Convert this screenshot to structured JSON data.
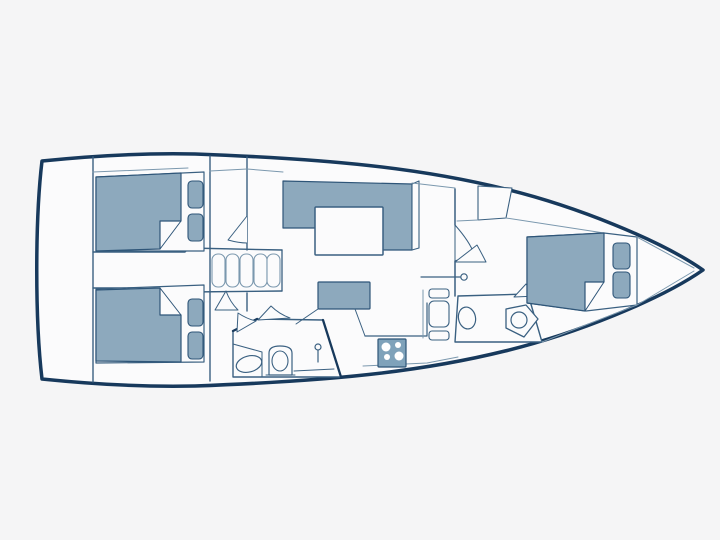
{
  "canvas": {
    "width": 720,
    "height": 540
  },
  "palette": {
    "background": "#f5f5f6",
    "hull_fill": "#fbfbfc",
    "hull_stroke": "#17395c",
    "line": "#3a6081",
    "line_light": "#7b98ae",
    "furniture_fill": "#8dا9bd",
    "furniture_fill_fix": "#8da9bd",
    "furniture_stroke": "#2e5578",
    "stove_fill": "#7fa2ba",
    "white": "#ffffff"
  },
  "floorplan": {
    "shapes": [
      {
        "name": "hull-outline",
        "kind": "path",
        "d": "M42,161 C100,155 150,153 195,154 C330,159 420,168 505,189 C575,206 660,240 703,270 C660,300 575,334 505,351 C420,372 330,381 195,386 C150,387 100,385 42,379 C35,320 35,220 42,161 Z",
        "fill": "hull_fill",
        "stroke": "hull_stroke",
        "sw": 3.5
      },
      {
        "name": "transom-line",
        "kind": "line",
        "x1": 93,
        "y1": 157,
        "x2": 93,
        "y2": 382,
        "stroke": "line",
        "sw": 1.4
      },
      {
        "name": "deck-line-aft-top",
        "kind": "line",
        "x1": 93,
        "y1": 172,
        "x2": 188,
        "y2": 168,
        "stroke": "line_light",
        "sw": 1
      },
      {
        "name": "corridor-top-wall",
        "kind": "path",
        "d": "M93,252 L185,252 L189,248 L282,250",
        "fill": "none",
        "stroke": "line",
        "sw": 1.4
      },
      {
        "name": "corridor-bottom-wall",
        "kind": "path",
        "d": "M93,288 L185,288 L189,292 L282,291",
        "fill": "none",
        "stroke": "line",
        "sw": 1.4
      },
      {
        "name": "aft-port-bed-base",
        "kind": "path",
        "d": "M96,177 L204,172 L204,251 L96,251 Z",
        "fill": "hull_fill",
        "stroke": "line",
        "sw": 1.2
      },
      {
        "name": "aft-port-bed",
        "kind": "path",
        "d": "M96,177 L181,173 L181,221 L160,221 L160,249 L96,251 Z",
        "fill": "furniture_fill_fix",
        "stroke": "furniture_stroke",
        "sw": 1.2
      },
      {
        "name": "aft-port-bed-fold-line",
        "kind": "line",
        "x1": 160,
        "y1": 249,
        "x2": 181,
        "y2": 221,
        "stroke": "furniture_stroke",
        "sw": 1
      },
      {
        "name": "aft-port-pillow-1",
        "kind": "rect",
        "x": 188,
        "y": 181,
        "w": 15,
        "h": 27,
        "rx": 4,
        "fill": "furniture_fill_fix",
        "stroke": "furniture_stroke",
        "sw": 1.1
      },
      {
        "name": "aft-port-pillow-2",
        "kind": "rect",
        "x": 188,
        "y": 214,
        "w": 15,
        "h": 27,
        "rx": 4,
        "fill": "furniture_fill_fix",
        "stroke": "furniture_stroke",
        "sw": 1.1
      },
      {
        "name": "aft-stbd-bed-base",
        "kind": "path",
        "d": "M96,289 L204,285 L204,362 L96,363 Z",
        "fill": "hull_fill",
        "stroke": "line",
        "sw": 1.2
      },
      {
        "name": "aft-stbd-bed",
        "kind": "path",
        "d": "M96,290 L160,288 L160,315 L181,315 L181,362 L96,361 Z",
        "fill": "furniture_fill_fix",
        "stroke": "furniture_stroke",
        "sw": 1.2
      },
      {
        "name": "aft-stbd-bed-fold-line",
        "kind": "line",
        "x1": 160,
        "y1": 288,
        "x2": 181,
        "y2": 315,
        "stroke": "furniture_stroke",
        "sw": 1
      },
      {
        "name": "aft-stbd-pillow-1",
        "kind": "rect",
        "x": 188,
        "y": 299,
        "w": 15,
        "h": 27,
        "rx": 4,
        "fill": "furniture_fill_fix",
        "stroke": "furniture_stroke",
        "sw": 1.1
      },
      {
        "name": "aft-stbd-pillow-2",
        "kind": "rect",
        "x": 188,
        "y": 332,
        "w": 15,
        "h": 27,
        "rx": 4,
        "fill": "furniture_fill_fix",
        "stroke": "furniture_stroke",
        "sw": 1.1
      },
      {
        "name": "wall-inner-aft",
        "kind": "line",
        "x1": 210,
        "y1": 156,
        "x2": 210,
        "y2": 381,
        "stroke": "line",
        "sw": 1.4
      },
      {
        "name": "wall-closet-top",
        "kind": "line",
        "x1": 247,
        "y1": 157,
        "x2": 247,
        "y2": 250,
        "stroke": "line",
        "sw": 1.4
      },
      {
        "name": "wall-closet-bottom",
        "kind": "line",
        "x1": 247,
        "y1": 293,
        "x2": 247,
        "y2": 311,
        "stroke": "line",
        "sw": 1.4
      },
      {
        "name": "deck-line-mid-top",
        "kind": "line",
        "x1": 210,
        "y1": 171,
        "x2": 247,
        "y2": 169,
        "stroke": "line_light",
        "sw": 1
      },
      {
        "name": "closet-door-swing",
        "kind": "path",
        "d": "M247,216 L228,240 Q239,243 247,243",
        "fill": "hull_fill",
        "stroke": "line",
        "sw": 1
      },
      {
        "name": "companionway-step-1",
        "kind": "rect",
        "x": 212,
        "y": 254,
        "w": 13,
        "h": 33,
        "rx": 6,
        "fill": "hull_fill",
        "stroke": "line_light",
        "sw": 1.1
      },
      {
        "name": "companionway-step-2",
        "kind": "rect",
        "x": 226,
        "y": 254,
        "w": 13,
        "h": 33,
        "rx": 6,
        "fill": "hull_fill",
        "stroke": "line_light",
        "sw": 1.1
      },
      {
        "name": "companionway-step-3",
        "kind": "rect",
        "x": 240,
        "y": 254,
        "w": 13,
        "h": 33,
        "rx": 6,
        "fill": "hull_fill",
        "stroke": "line_light",
        "sw": 1.1
      },
      {
        "name": "companionway-step-4",
        "kind": "rect",
        "x": 254,
        "y": 254,
        "w": 13,
        "h": 33,
        "rx": 6,
        "fill": "hull_fill",
        "stroke": "line_light",
        "sw": 1.1
      },
      {
        "name": "companionway-step-5",
        "kind": "rect",
        "x": 267,
        "y": 254,
        "w": 13,
        "h": 33,
        "rx": 6,
        "fill": "hull_fill",
        "stroke": "line_light",
        "sw": 1.1
      },
      {
        "name": "steps-right-wall",
        "kind": "line",
        "x1": 282,
        "y1": 250,
        "x2": 282,
        "y2": 291,
        "stroke": "line",
        "sw": 1.3
      },
      {
        "name": "aft-head-room",
        "kind": "path",
        "d": "M233,331 L257,319 L323,320 L341,377 L233,377 Z",
        "fill": "hull_fill",
        "stroke": "line",
        "sw": 1.4
      },
      {
        "name": "aft-head-thick-walls",
        "kind": "path",
        "d": "M257,319 L233,331 M323,320 L341,377",
        "fill": "none",
        "stroke": "hull_stroke",
        "sw": 2.3
      },
      {
        "name": "cabin-door-swing-stbd",
        "kind": "path",
        "d": "M215,310 L226,291 Q230,302 238,310 Z",
        "fill": "hull_fill",
        "stroke": "line",
        "sw": 1
      },
      {
        "name": "aft-head-door-swing-left",
        "kind": "path",
        "d": "M237,332 L238,313 Q247,319 256,321 Z",
        "fill": "hull_fill",
        "stroke": "line",
        "sw": 1
      },
      {
        "name": "aft-head-door-swing-right",
        "kind": "path",
        "d": "M258,320 L271,306 Q279,314 290,318 Z",
        "fill": "hull_fill",
        "stroke": "line",
        "sw": 1
      },
      {
        "name": "aft-head-counter-line",
        "kind": "path",
        "d": "M233,344 L262,352 L262,377",
        "fill": "none",
        "stroke": "line",
        "sw": 1
      },
      {
        "name": "aft-head-sink",
        "kind": "ellipse",
        "cx": 249,
        "cy": 364,
        "rx": 13,
        "ry": 8,
        "rot": -15,
        "fill": "hull_fill",
        "stroke": "line",
        "sw": 1.2
      },
      {
        "name": "aft-head-toilet-body",
        "kind": "path",
        "d": "M269,375 L269,353 Q269,346 280,346 Q292,346 292,353 L292,375 Z",
        "fill": "hull_fill",
        "stroke": "line",
        "sw": 1.2
      },
      {
        "name": "aft-head-toilet-bowl",
        "kind": "ellipse",
        "cx": 280,
        "cy": 361,
        "rx": 8,
        "ry": 10,
        "fill": "hull_fill",
        "stroke": "line",
        "sw": 1.1
      },
      {
        "name": "aft-head-toilet-base-line",
        "kind": "line",
        "x1": 266,
        "y1": 375,
        "x2": 295,
        "y2": 375,
        "stroke": "line",
        "sw": 1
      },
      {
        "name": "aft-head-shelf-line",
        "kind": "line",
        "x1": 294,
        "y1": 371,
        "x2": 334,
        "y2": 369,
        "stroke": "line",
        "sw": 1
      },
      {
        "name": "aft-head-shower-stem",
        "kind": "line",
        "x1": 318,
        "y1": 350,
        "x2": 318,
        "y2": 362,
        "stroke": "line",
        "sw": 1.2
      },
      {
        "name": "aft-head-shower-head",
        "kind": "circle",
        "cx": 318,
        "cy": 347,
        "r": 3,
        "fill": "hull_fill",
        "stroke": "line",
        "sw": 1.2
      },
      {
        "name": "deck-line-salon-left",
        "kind": "line",
        "x1": 247,
        "y1": 169,
        "x2": 283,
        "y2": 172,
        "stroke": "line_light",
        "sw": 1
      },
      {
        "name": "salon-settee",
        "kind": "path",
        "d": "M283,181 L412,184 L412,250 L340,250 L340,228 L283,228 Z",
        "fill": "furniture_fill_fix",
        "stroke": "furniture_stroke",
        "sw": 1.2
      },
      {
        "name": "salon-settee-backrest",
        "kind": "path",
        "d": "M412,184 L419,181 L419,248 L412,250 Z",
        "fill": "hull_fill",
        "stroke": "line",
        "sw": 1.1
      },
      {
        "name": "salon-table",
        "kind": "rect",
        "x": 315,
        "y": 207,
        "w": 68,
        "h": 48,
        "rx": 1,
        "fill": "hull_fill",
        "stroke": "line",
        "sw": 1.5
      },
      {
        "name": "salon-bench",
        "kind": "rect",
        "x": 318,
        "y": 282,
        "w": 52,
        "h": 27,
        "rx": 1,
        "fill": "furniture_fill_fix",
        "stroke": "furniture_stroke",
        "sw": 1.2
      },
      {
        "name": "bench-floor-line-left",
        "kind": "line",
        "x1": 318,
        "y1": 309,
        "x2": 296,
        "y2": 324,
        "stroke": "line",
        "sw": 1
      },
      {
        "name": "bench-floor-line-right",
        "kind": "line",
        "x1": 355,
        "y1": 309,
        "x2": 365,
        "y2": 336,
        "stroke": "line",
        "sw": 1
      },
      {
        "name": "deck-line-salon-right",
        "kind": "line",
        "x1": 412,
        "y1": 183,
        "x2": 455,
        "y2": 188,
        "stroke": "line_light",
        "sw": 1
      },
      {
        "name": "galley-counter-top",
        "kind": "path",
        "d": "M365,336 L427,336 L427,303",
        "fill": "none",
        "stroke": "line",
        "sw": 1.2
      },
      {
        "name": "galley-front-edge",
        "kind": "path",
        "d": "M363,366 L427,363 L458,357",
        "fill": "none",
        "stroke": "line_light",
        "sw": 1
      },
      {
        "name": "galley-stove",
        "kind": "rect",
        "x": 378,
        "y": 339,
        "w": 28,
        "h": 28,
        "rx": 1,
        "fill": "stove_fill",
        "stroke": "furniture_stroke",
        "sw": 1.2
      },
      {
        "name": "stove-burner-1",
        "kind": "circle",
        "cx": 386,
        "cy": 347,
        "r": 4.5,
        "fill": "white",
        "stroke": "none",
        "sw": 0
      },
      {
        "name": "stove-burner-2",
        "kind": "circle",
        "cx": 398,
        "cy": 345,
        "r": 3,
        "fill": "white",
        "stroke": "none",
        "sw": 0
      },
      {
        "name": "stove-burner-3",
        "kind": "circle",
        "cx": 387,
        "cy": 357,
        "r": 3,
        "fill": "white",
        "stroke": "none",
        "sw": 0
      },
      {
        "name": "stove-burner-4",
        "kind": "circle",
        "cx": 399,
        "cy": 356,
        "r": 4.5,
        "fill": "white",
        "stroke": "none",
        "sw": 0
      },
      {
        "name": "galley-unit-edge",
        "kind": "line",
        "x1": 423,
        "y1": 290,
        "x2": 423,
        "y2": 338,
        "stroke": "line_light",
        "sw": 1
      },
      {
        "name": "galley-drawer-top",
        "kind": "rect",
        "x": 429,
        "y": 289,
        "w": 20,
        "h": 9,
        "rx": 3,
        "fill": "hull_fill",
        "stroke": "line",
        "sw": 1.1
      },
      {
        "name": "galley-drawer-mid",
        "kind": "rect",
        "x": 429,
        "y": 301,
        "w": 20,
        "h": 26,
        "rx": 5,
        "fill": "hull_fill",
        "stroke": "line",
        "sw": 1.1
      },
      {
        "name": "galley-drawer-low",
        "kind": "rect",
        "x": 429,
        "y": 331,
        "w": 20,
        "h": 9,
        "rx": 3,
        "fill": "hull_fill",
        "stroke": "line",
        "sw": 1.1
      },
      {
        "name": "bulkhead-fwd",
        "kind": "path",
        "d": "M455,189 L455,225 M455,261 L455,296",
        "fill": "none",
        "stroke": "line",
        "sw": 1.5
      },
      {
        "name": "fwd-cabin-door-swing",
        "kind": "path",
        "d": "M455,225 Q470,242 474,254 L455,261 Z",
        "fill": "hull_fill",
        "stroke": "line",
        "sw": 1
      },
      {
        "name": "galley-door-swing",
        "kind": "path",
        "d": "M455,262 L477,245 Q482,254 486,262 Z",
        "fill": "hull_fill",
        "stroke": "line",
        "sw": 1
      },
      {
        "name": "galley-door-panel",
        "kind": "line",
        "x1": 421,
        "y1": 277,
        "x2": 460,
        "y2": 277,
        "stroke": "line",
        "sw": 1.2
      },
      {
        "name": "galley-door-knob",
        "kind": "circle",
        "cx": 464,
        "cy": 277,
        "r": 3.2,
        "fill": "hull_fill",
        "stroke": "line",
        "sw": 1.2
      },
      {
        "name": "fwd-head-room",
        "kind": "path",
        "d": "M458,296 L528,294 L542,342 L455,342 Z",
        "fill": "hull_fill",
        "stroke": "line",
        "sw": 1.4
      },
      {
        "name": "fwd-head-sink",
        "kind": "ellipse",
        "cx": 467,
        "cy": 318,
        "rx": 8.5,
        "ry": 11,
        "rot": -12,
        "fill": "hull_fill",
        "stroke": "line",
        "sw": 1.2
      },
      {
        "name": "fwd-head-toilet-body",
        "kind": "path",
        "d": "M506,309 L526,305 L538,319 L524,337 L506,328 Z",
        "fill": "hull_fill",
        "stroke": "line",
        "sw": 1.3
      },
      {
        "name": "fwd-head-toilet-bowl",
        "kind": "circle",
        "cx": 519,
        "cy": 320,
        "r": 8,
        "fill": "hull_fill",
        "stroke": "line",
        "sw": 1.2
      },
      {
        "name": "fwd-head-door-swing",
        "kind": "path",
        "d": "M514,297 L526,284 Q531,291 538,296 Z",
        "fill": "hull_fill",
        "stroke": "line",
        "sw": 1
      },
      {
        "name": "fwd-locker",
        "kind": "path",
        "d": "M478,186 L512,188 L506,218 L478,220 Z",
        "fill": "hull_fill",
        "stroke": "line",
        "sw": 1.1
      },
      {
        "name": "fwd-locker-base-line",
        "kind": "line",
        "x1": 457,
        "y1": 221,
        "x2": 478,
        "y2": 220,
        "stroke": "line_light",
        "sw": 1
      },
      {
        "name": "deck-line-fwd",
        "kind": "line",
        "x1": 506,
        "y1": 218,
        "x2": 604,
        "y2": 233,
        "stroke": "line_light",
        "sw": 1
      },
      {
        "name": "fwd-bed-base",
        "kind": "path",
        "d": "M527,237 L604,233 L637,237 L637,305 L586,311 L527,303 Z",
        "fill": "hull_fill",
        "stroke": "line",
        "sw": 1.2
      },
      {
        "name": "fwd-bed",
        "kind": "path",
        "d": "M527,237 L604,233 L604,282 L585,282 L585,311 L527,303 Z",
        "fill": "furniture_fill_fix",
        "stroke": "furniture_stroke",
        "sw": 1.2
      },
      {
        "name": "fwd-bed-fold-line",
        "kind": "line",
        "x1": 585,
        "y1": 311,
        "x2": 604,
        "y2": 282,
        "stroke": "furniture_stroke",
        "sw": 1
      },
      {
        "name": "fwd-pillow-1",
        "kind": "rect",
        "x": 613,
        "y": 243,
        "w": 17,
        "h": 26,
        "rx": 4,
        "fill": "furniture_fill_fix",
        "stroke": "furniture_stroke",
        "sw": 1.1
      },
      {
        "name": "fwd-pillow-2",
        "kind": "rect",
        "x": 613,
        "y": 272,
        "w": 17,
        "h": 26,
        "rx": 4,
        "fill": "furniture_fill_fix",
        "stroke": "furniture_stroke",
        "sw": 1.1
      },
      {
        "name": "bow-inner-line-top",
        "kind": "line",
        "x1": 637,
        "y1": 237,
        "x2": 694,
        "y2": 268,
        "stroke": "line_light",
        "sw": 1
      },
      {
        "name": "bow-inner-line-bottom",
        "kind": "line",
        "x1": 637,
        "y1": 305,
        "x2": 694,
        "y2": 271,
        "stroke": "line_light",
        "sw": 1
      },
      {
        "name": "bow-floor-line",
        "kind": "line",
        "x1": 542,
        "y1": 342,
        "x2": 637,
        "y2": 305,
        "stroke": "line_light",
        "sw": 1
      }
    ]
  }
}
